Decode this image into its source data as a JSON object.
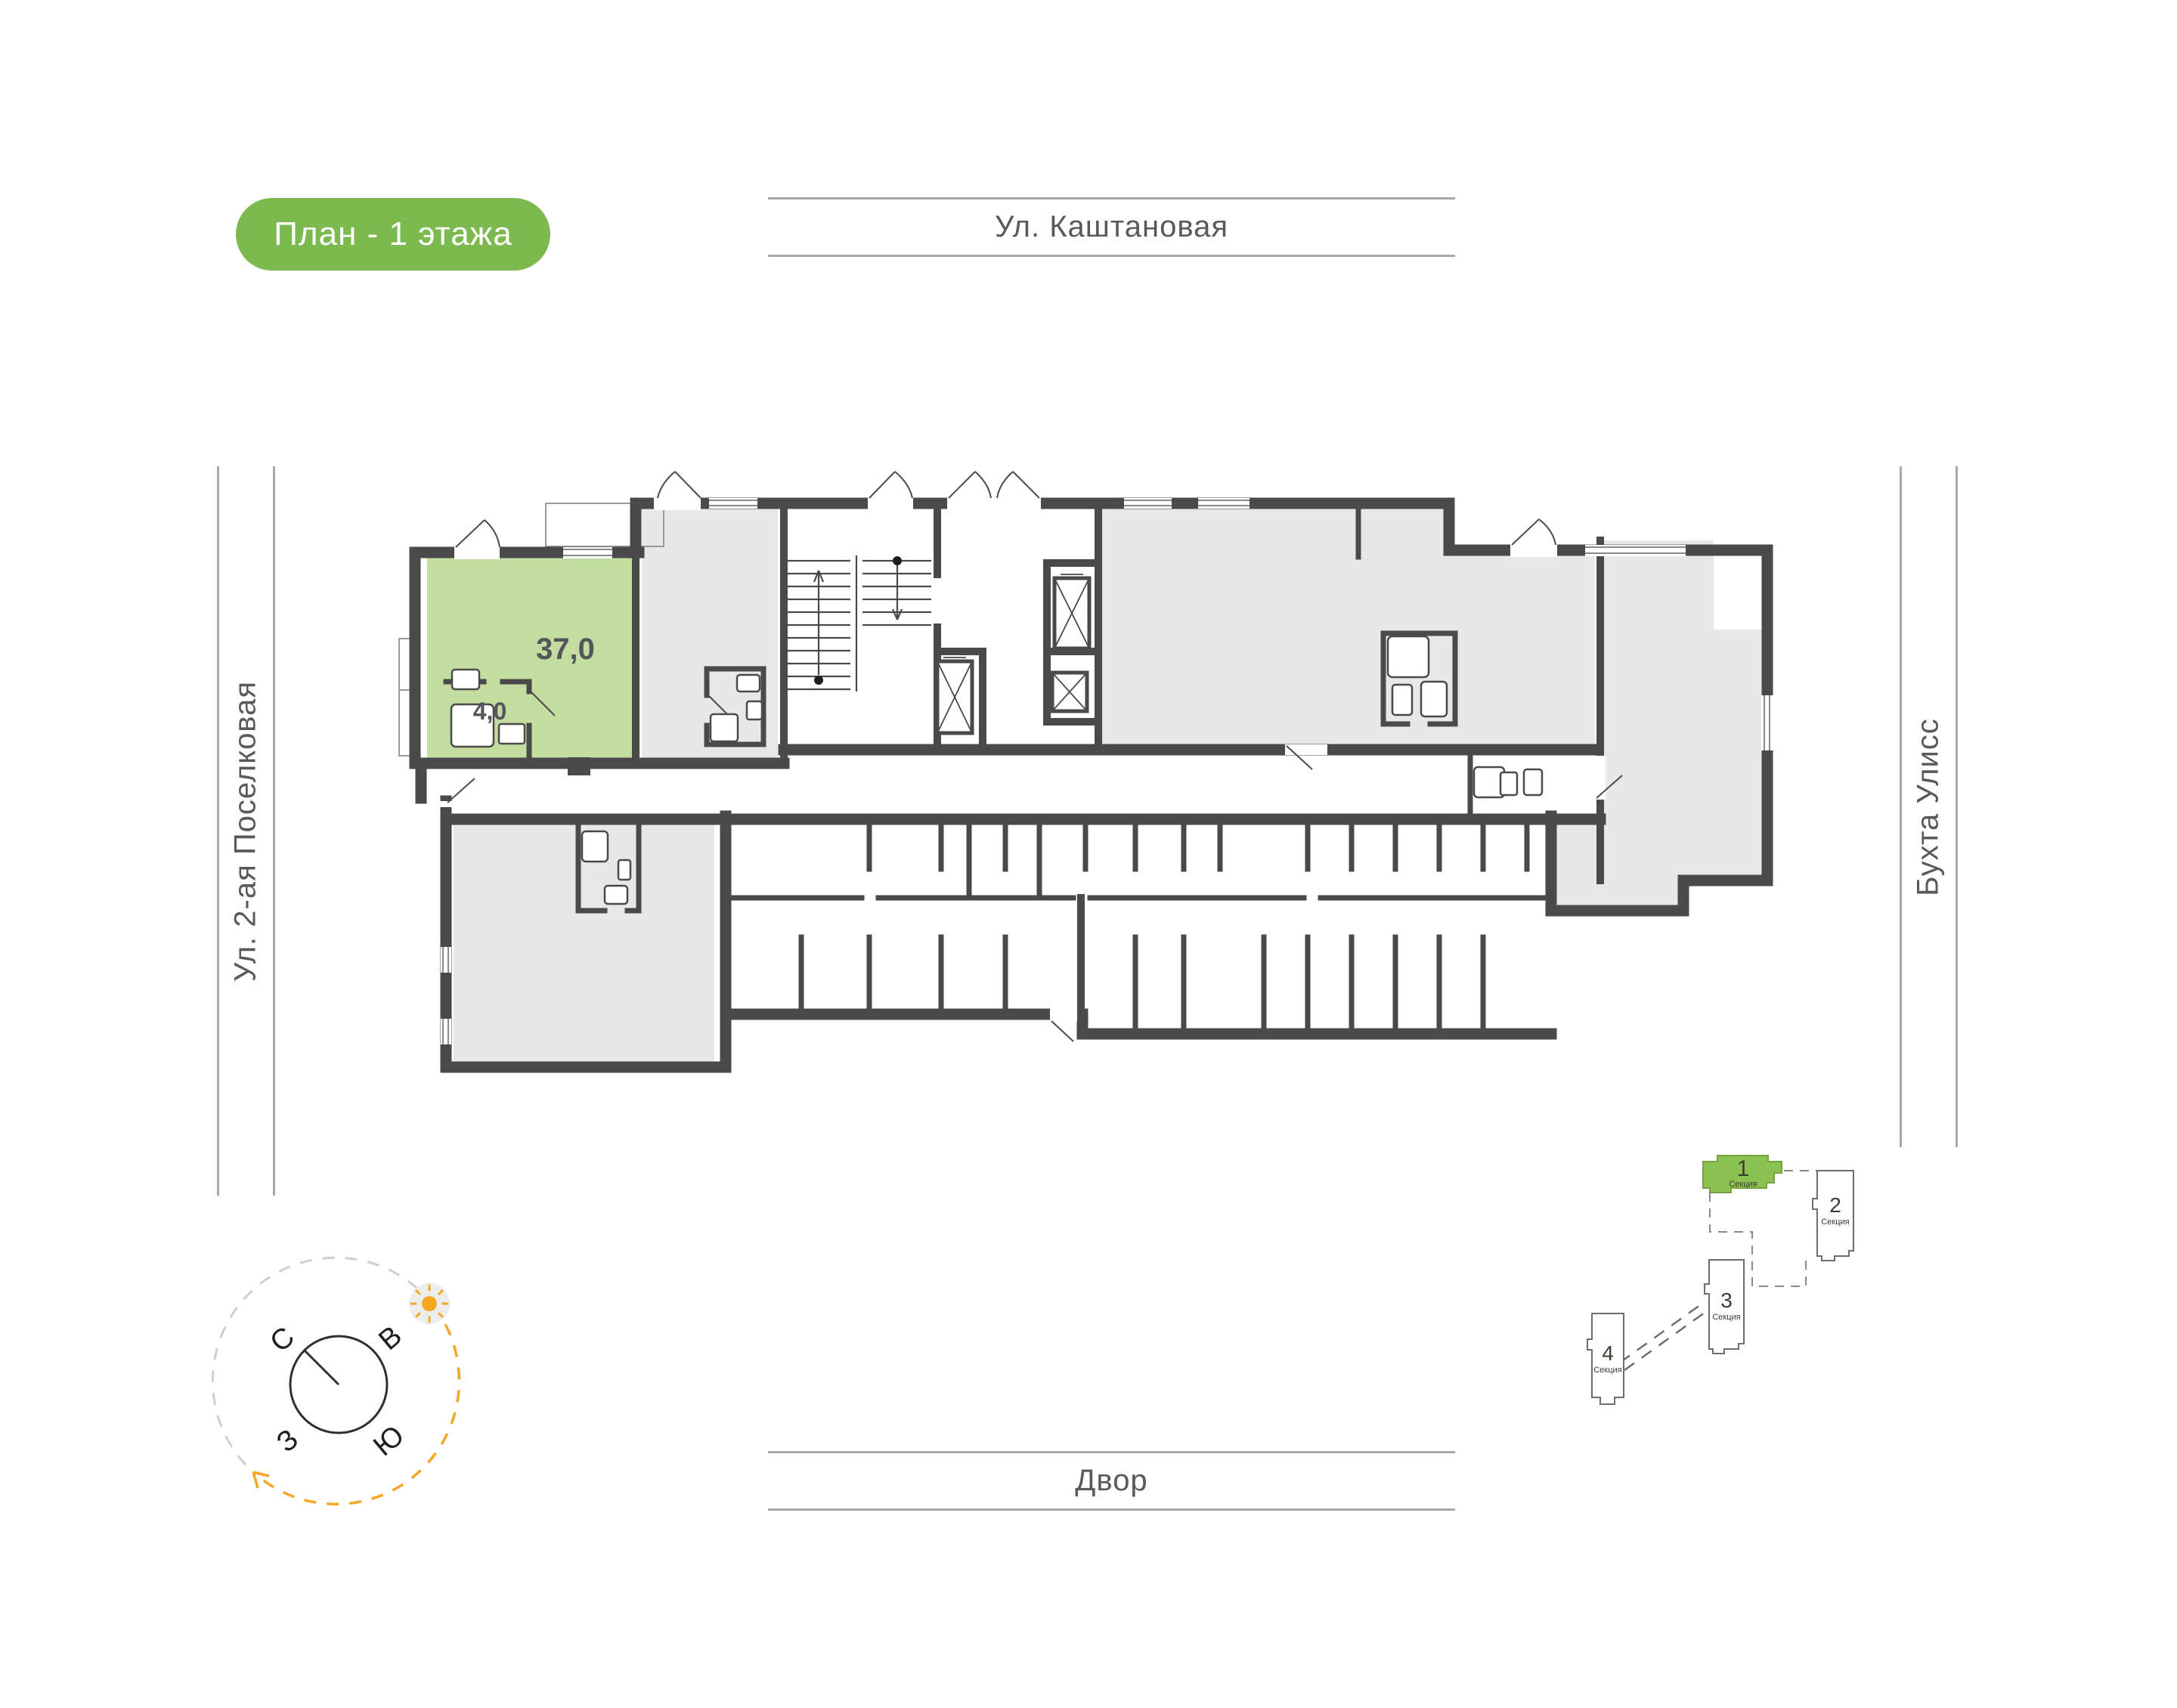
{
  "page": {
    "title_badge": "План - 1 этажа"
  },
  "streets": {
    "top": "Ул. Каштановая",
    "left": "Ул. 2-ая Поселковая",
    "right": "Бухта Улисс",
    "bottom": "Двор"
  },
  "plan": {
    "apartment": {
      "area_main": "37,0",
      "area_bath": "4,0"
    }
  },
  "compass": {
    "n": "С",
    "e": "В",
    "w": "З",
    "s": "Ю"
  },
  "minimap": {
    "sections": [
      {
        "number": "1",
        "label": "Секция",
        "highlighted": true
      },
      {
        "number": "2",
        "label": "Секция",
        "highlighted": false
      },
      {
        "number": "3",
        "label": "Секция",
        "highlighted": false
      },
      {
        "number": "4",
        "label": "Секция",
        "highlighted": false
      }
    ]
  },
  "colors": {
    "badge_green": "#7CB94E",
    "apartment_green": "#C3DCA0",
    "minimap_green": "#8BC152",
    "wall": "#4A4A4A",
    "room_gray": "#E8E8E8",
    "street_line": "#A8A8A8",
    "street_text": "#58595B",
    "accent_orange": "#F5A623"
  }
}
